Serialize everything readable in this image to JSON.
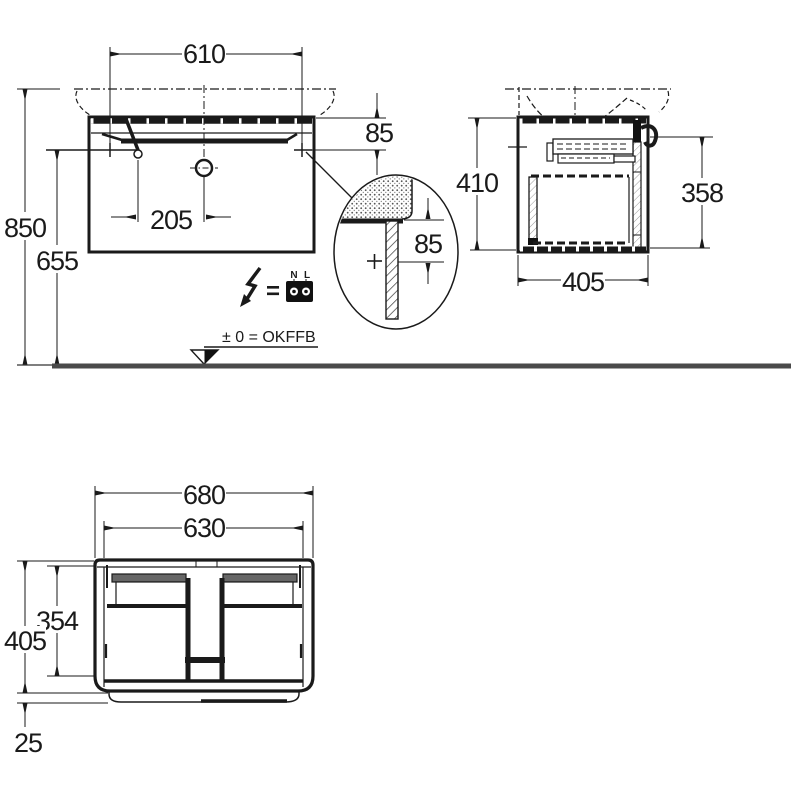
{
  "colors": {
    "line": "#1a1a1a",
    "floor": "#4a4a4a",
    "background": "#ffffff"
  },
  "front_view": {
    "dim_basin_width": "610",
    "dim_top_to_fixing": "85",
    "dim_drain_to_faucet": "205",
    "dim_height_total": "850",
    "dim_height_fixing": "655"
  },
  "detail_view": {
    "dim_edge_to_fixing": "85"
  },
  "side_view": {
    "dim_cabinet_height": "410",
    "dim_front_height": "358",
    "dim_cabinet_depth": "405"
  },
  "plan_view": {
    "dim_outer_width": "680",
    "dim_inner_width": "630",
    "dim_inner_depth": "354",
    "dim_outer_depth": "405",
    "dim_front_offset": "25"
  },
  "electrical": {
    "terminal_left": "N",
    "terminal_right": "L",
    "equals_sign": "="
  },
  "datum": {
    "label": "± 0 = OKFFB"
  }
}
